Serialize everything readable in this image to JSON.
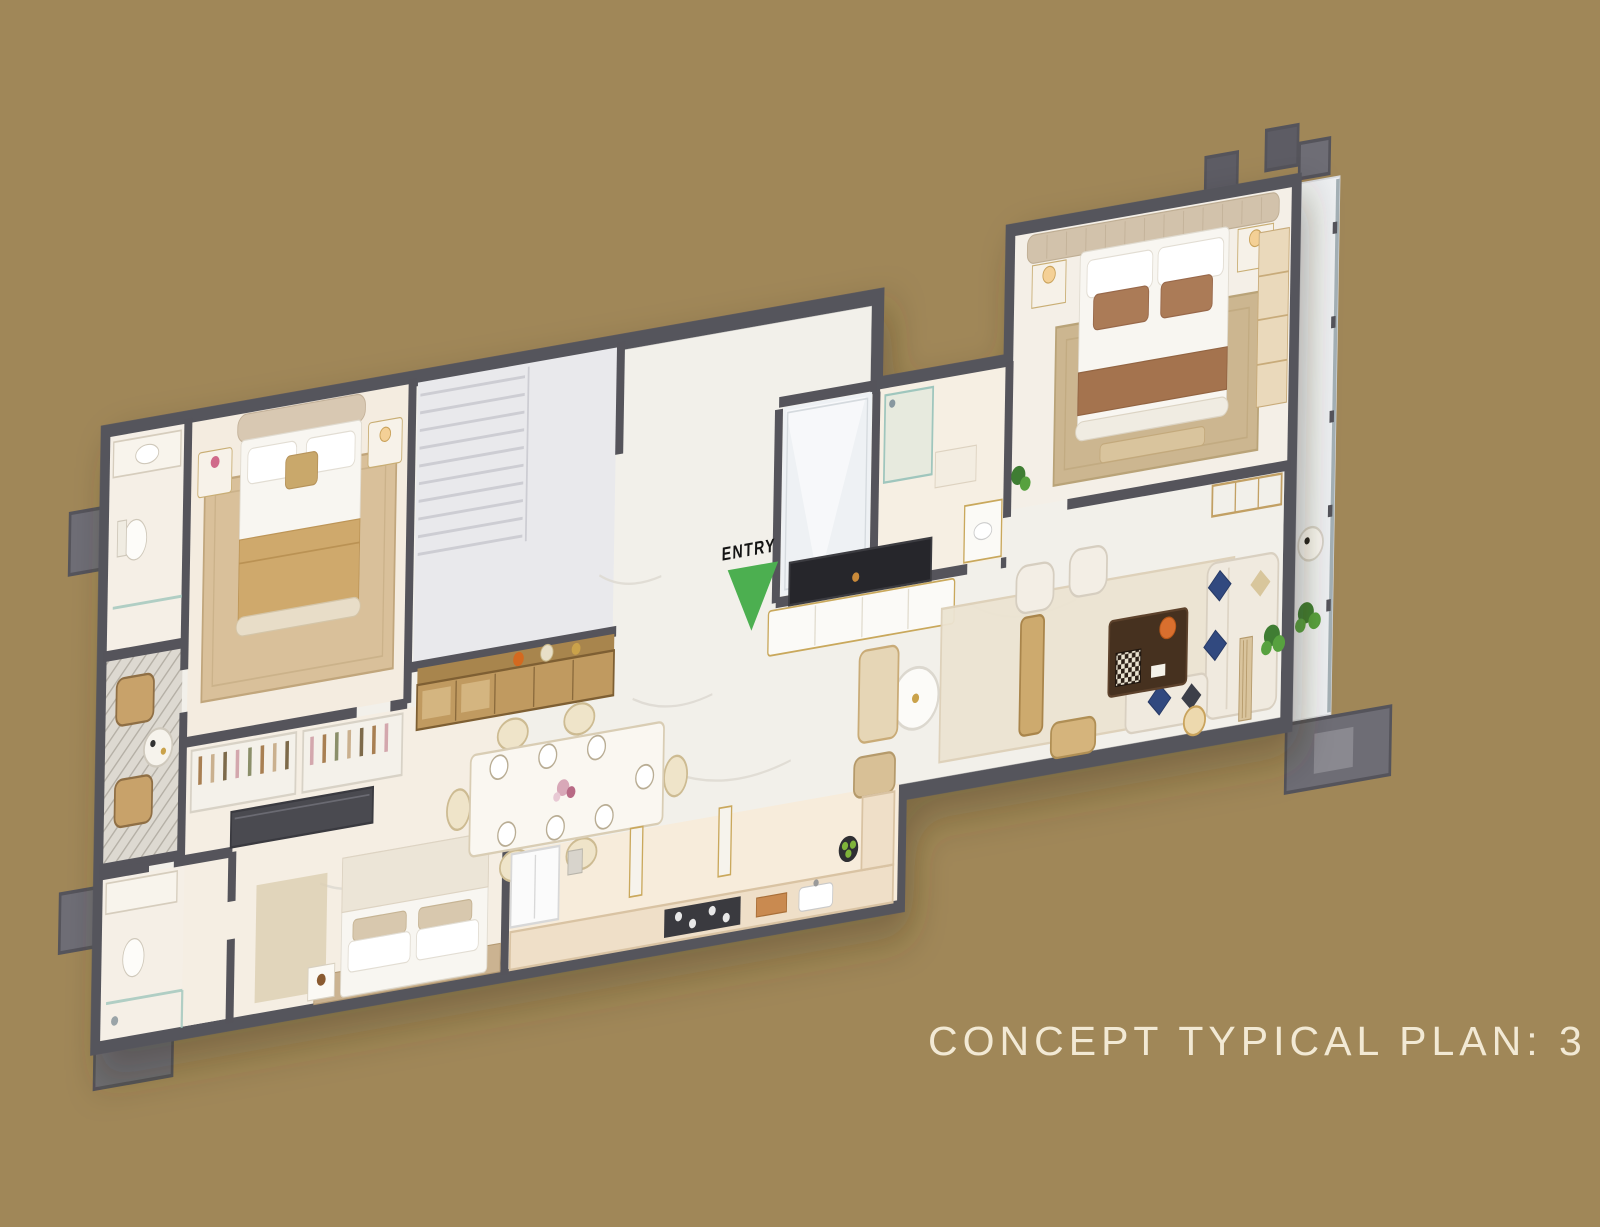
{
  "page": {
    "width": 1600,
    "height": 1227,
    "background_color": "#a08758"
  },
  "caption": {
    "text": "CONCEPT TYPICAL PLAN: 3 BHK",
    "color": "#f2e9d4"
  },
  "plan": {
    "entry_label": "ENTRY",
    "entry_arrow_color": "#4caf50",
    "palette": {
      "wall": "#55545b",
      "floor_marble": "#f2f0ea",
      "floor_warm": "#f7ecdb",
      "floor_stairs": "#e9e9ec",
      "rug_tan": "#d9c09a",
      "rug_master": "#ccb690",
      "wood_gold": "#c09a60",
      "furniture_cream": "#f0eadf",
      "furniture_gold": "#cdaa6e",
      "blanket_gold": "#cfa96c",
      "pillow_brown": "#ab7b57",
      "pillow_blue": "#31497f",
      "table_darkwood": "#46311f",
      "tv_black": "#26262b",
      "plant_green": "#57a13f",
      "glass": "#9fc6bd",
      "parapet_gray": "#6e6d75"
    }
  }
}
